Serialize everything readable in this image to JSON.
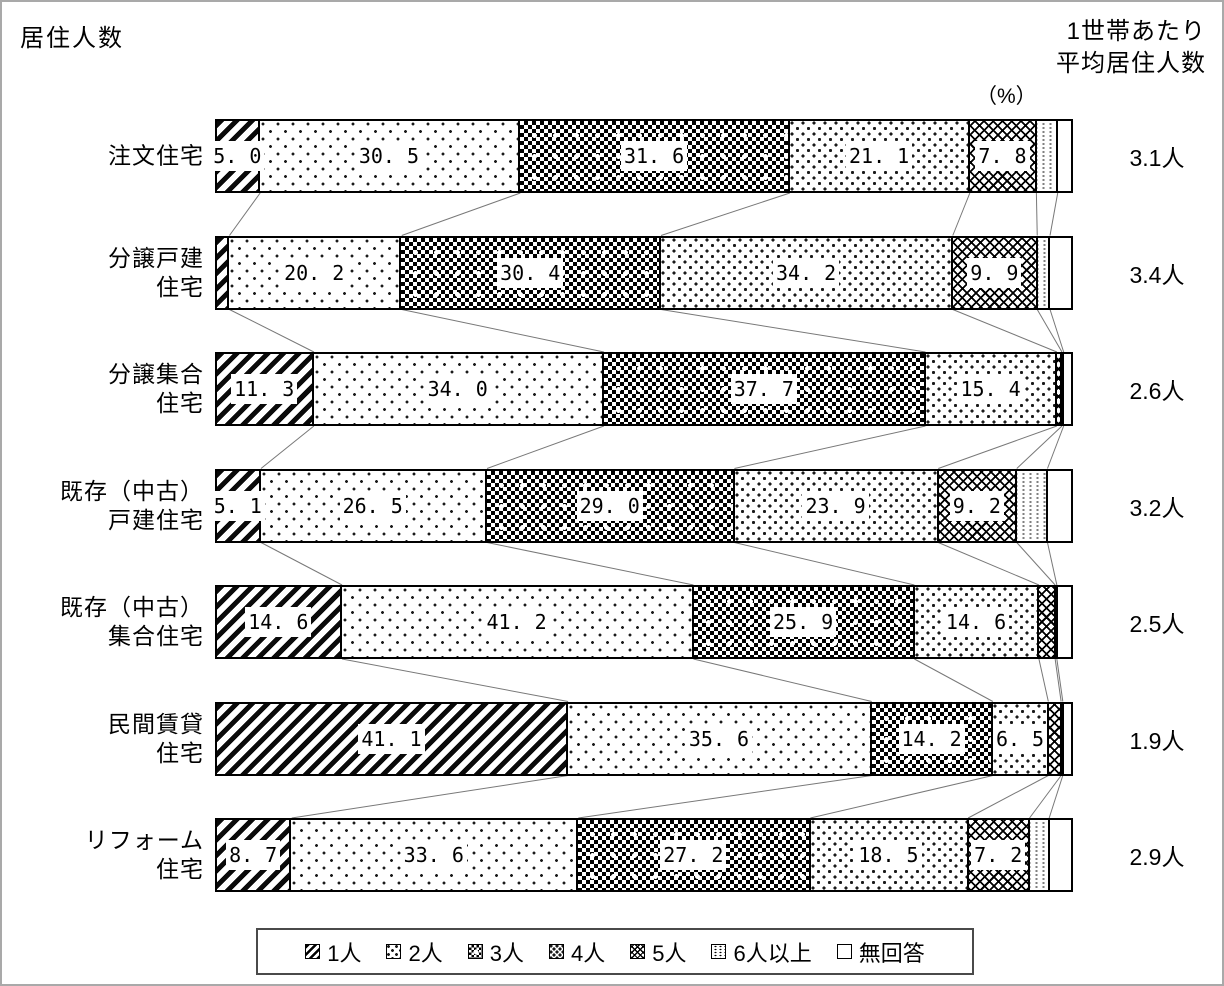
{
  "frame": {
    "title": "居住人数",
    "right_header_line1": "1世帯あたり",
    "right_header_line2": "平均居住人数",
    "unit_label": "（%）"
  },
  "chart_data": {
    "type": "bar",
    "subtype": "horizontal-stacked-100-percent",
    "title": "居住人数",
    "unit": "%",
    "x_range_percent": [
      0,
      100
    ],
    "grid": false,
    "legend_position": "bottom",
    "right_axis_title_lines": [
      "1世帯あたり",
      "平均居住人数"
    ],
    "unit_label": "（%）",
    "series": [
      "1人",
      "2人",
      "3人",
      "4人",
      "5人",
      "6人以上",
      "無回答"
    ],
    "note": "values for 6人以上 and 無回答 (and other unlabeled slivers) are estimated from segment widths; labeled values are printed on the chart",
    "rows": [
      {
        "category": [
          "注文住宅"
        ],
        "values": [
          5.0,
          30.5,
          31.6,
          21.1,
          7.8,
          2.5,
          1.5
        ],
        "value_labels": [
          "5. 0",
          "30. 5",
          "31. 6",
          "21. 1",
          "7. 8",
          null,
          null
        ],
        "average": "3.1人"
      },
      {
        "category": [
          "分譲戸建",
          "住宅"
        ],
        "values": [
          1.4,
          20.2,
          30.4,
          34.2,
          9.9,
          1.5,
          2.4
        ],
        "value_labels": [
          null,
          "20. 2",
          "30. 4",
          "34. 2",
          "9. 9",
          null,
          null
        ],
        "average": "3.4人"
      },
      {
        "category": [
          "分譲集合",
          "住宅"
        ],
        "values": [
          11.3,
          34.0,
          37.7,
          15.4,
          0.6,
          0.2,
          0.8
        ],
        "value_labels": [
          "11. 3",
          "34. 0",
          "37. 7",
          "15. 4",
          null,
          null,
          null
        ],
        "average": "2.6人"
      },
      {
        "category": [
          "既存（中古）",
          "戸建住宅"
        ],
        "values": [
          5.1,
          26.5,
          29.0,
          23.9,
          9.2,
          3.6,
          2.7
        ],
        "value_labels": [
          "5. 1",
          "26. 5",
          "29. 0",
          "23. 9",
          "9. 2",
          null,
          null
        ],
        "average": "3.2人"
      },
      {
        "category": [
          "既存（中古）",
          "集合住宅"
        ],
        "values": [
          14.6,
          41.2,
          25.9,
          14.6,
          1.9,
          0.2,
          1.6
        ],
        "value_labels": [
          "14. 6",
          "41. 2",
          "25. 9",
          "14. 6",
          null,
          null,
          null
        ],
        "average": "2.5人"
      },
      {
        "category": [
          "民間賃貸",
          "住宅"
        ],
        "values": [
          41.1,
          35.6,
          14.2,
          6.5,
          1.5,
          0.2,
          0.9
        ],
        "value_labels": [
          "41. 1",
          "35. 6",
          "14. 2",
          "6. 5",
          null,
          null,
          null
        ],
        "average": "1.9人"
      },
      {
        "category": [
          "リフォーム",
          "住宅"
        ],
        "values": [
          8.7,
          33.6,
          27.2,
          18.5,
          7.2,
          2.3,
          2.5
        ],
        "value_labels": [
          "8. 7",
          "33. 6",
          "27. 2",
          "18. 5",
          "7. 2",
          null,
          null
        ],
        "average": "2.9人"
      }
    ]
  }
}
